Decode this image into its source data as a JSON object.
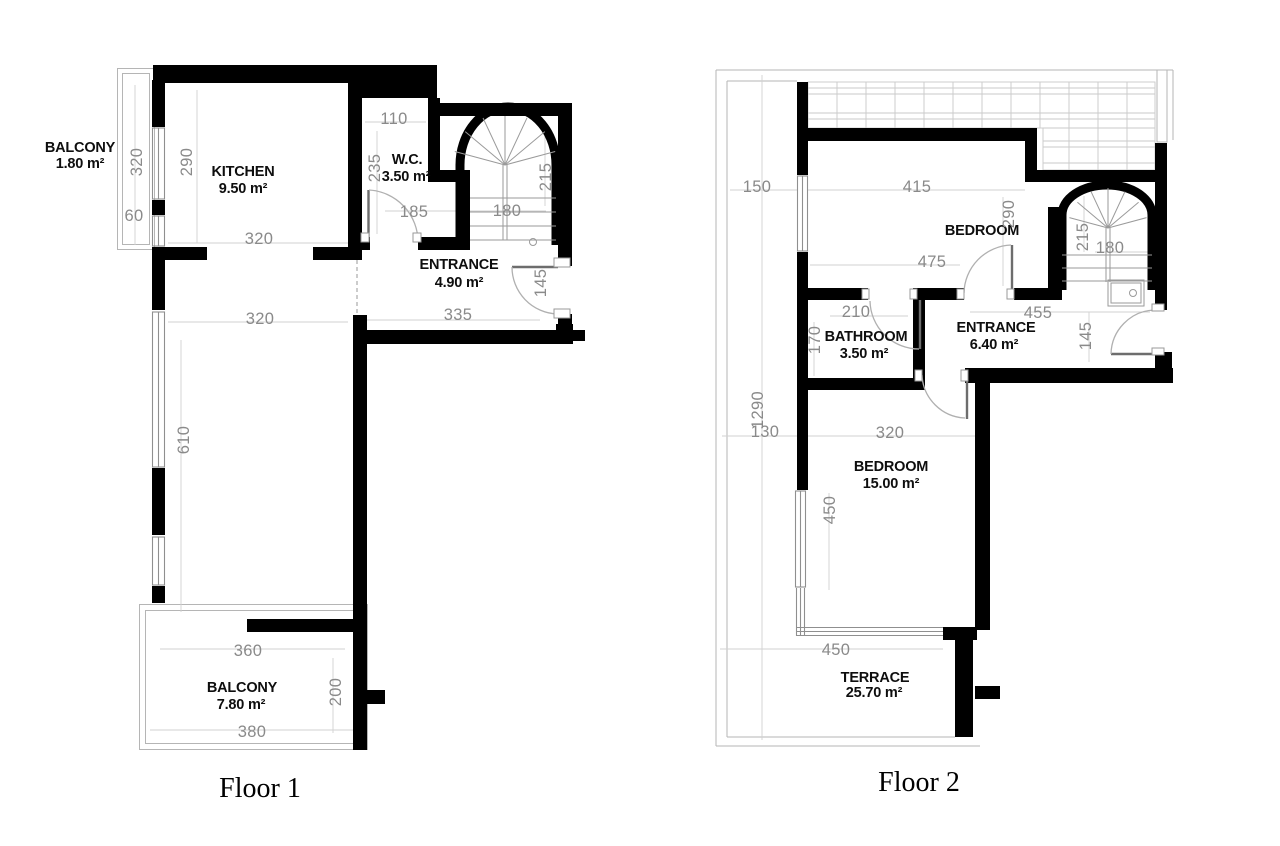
{
  "colors": {
    "wall": "#000000",
    "dimension_text": "#8a8a8a",
    "room_text": "#0e0e0e",
    "thin_line": "#b5b5b5",
    "background": "#ffffff"
  },
  "floor1": {
    "label": "Floor 1",
    "rooms": {
      "balcony_top": {
        "name": "BALCONY",
        "area": "1.80 m²"
      },
      "kitchen": {
        "name": "KITCHEN",
        "area": "9.50 m²"
      },
      "wc": {
        "name": "W.C.",
        "area": "3.50 m²"
      },
      "entrance": {
        "name": "ENTRANCE",
        "area": "4.90 m²"
      },
      "balcony_bottom": {
        "name": "BALCONY",
        "area": "7.80 m²"
      }
    },
    "dims": {
      "balcony_len": "320",
      "balcony_wall": "60",
      "kitchen_depth": "290",
      "kitchen_width": "320",
      "wc_top": "110",
      "wc_depth": "235",
      "wc_door_wall": "185",
      "stair_width": "180",
      "stair_depth": "215",
      "passage_width": "320",
      "entrance_width": "335",
      "entry_door": "145",
      "living_len": "610",
      "balcony2_top": "360",
      "balcony2_depth": "200",
      "balcony2_bottom": "380"
    }
  },
  "floor2": {
    "label": "Floor 2",
    "rooms": {
      "bedroom1": {
        "name": "BEDROOM"
      },
      "bathroom": {
        "name": "BATHROOM",
        "area": "3.50 m²"
      },
      "entrance": {
        "name": "ENTRANCE",
        "area": "6.40 m²"
      },
      "bedroom2": {
        "name": "BEDROOM",
        "area": "15.00 m²"
      },
      "terrace": {
        "name": "TERRACE",
        "area": "25.70 m²"
      }
    },
    "dims": {
      "left_top": "150",
      "top_width": "415",
      "bedroom1_depth": "290",
      "bedroom1_width": "475",
      "stair_depth": "215",
      "stair_width": "180",
      "bathroom_top": "210",
      "bathroom_depth": "170",
      "entrance_width": "455",
      "entry_door": "145",
      "total_height": "1290",
      "left_mid": "130",
      "bedroom2_width": "320",
      "bedroom2_depth": "450",
      "terrace_width": "450"
    }
  }
}
